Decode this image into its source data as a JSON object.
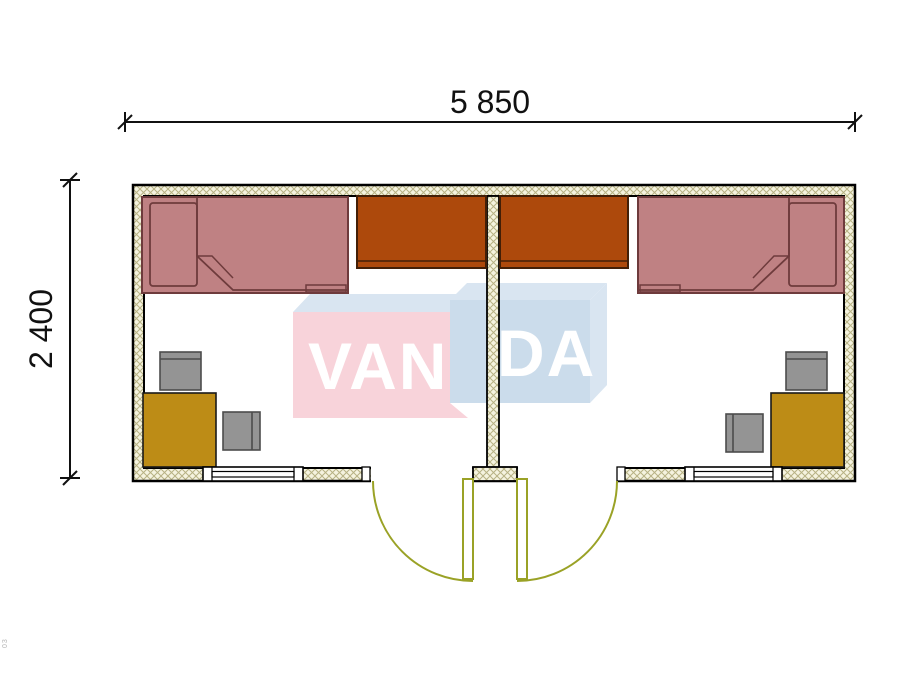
{
  "drawing": {
    "dimensions": {
      "width_label": "5 850",
      "height_label": "2 400"
    },
    "watermark": {
      "left_text": "VAN",
      "right_text": "DA"
    },
    "corner_note": "03",
    "colors": {
      "bed": "#bf8183",
      "wardrobe": "#ad490c",
      "desk": "#bd8c16",
      "chair": "#949494",
      "door": "#9aa226",
      "wall_hatch_bg": "#f5f3df",
      "wall_hatch_line": "#b7b184",
      "floor": "#ffffff",
      "watermark_pink": "#f8d3da",
      "watermark_blue": "#cbdceb",
      "watermark_bevel": "#d9e5f1",
      "dimension_line": "#111111"
    },
    "rooms": [
      {
        "id": "left",
        "furniture": [
          "bed",
          "wardrobe",
          "desk",
          "chair",
          "chair"
        ],
        "openings": [
          "window",
          "door"
        ]
      },
      {
        "id": "right",
        "furniture": [
          "bed",
          "wardrobe",
          "desk",
          "chair",
          "chair"
        ],
        "openings": [
          "window",
          "door"
        ]
      }
    ]
  }
}
